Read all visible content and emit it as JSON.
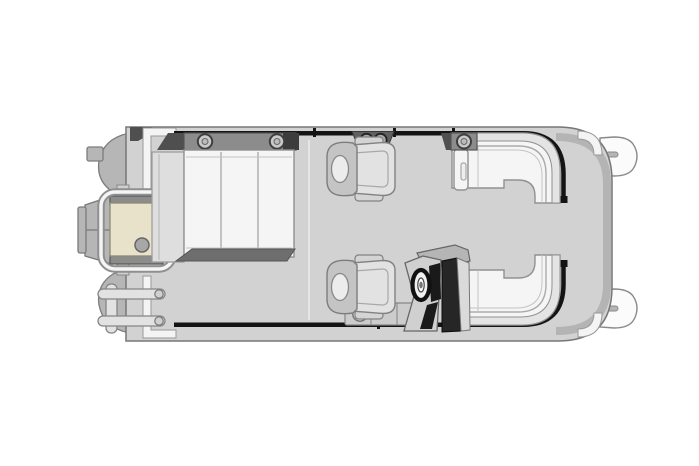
{
  "meta": {
    "description": "Top-view pontoon boat floor plan line drawing",
    "background": "#ffffff"
  },
  "colors": {
    "bg": "#ffffff",
    "deck": "#d2d2d2",
    "deckStroke": "#777777",
    "rim": "#b4b4b4",
    "pontoon": "#b6b6b6",
    "pontoonStroke": "#7c7c7c",
    "pontoonDark": "#9a9a9a",
    "fence": "#141414",
    "cushion": "#f5f5f5",
    "cushionBand": "#e4e4e4",
    "cushionStroke": "#919191",
    "whiteTrim": "#f4f4f4",
    "darkTrim": "#4f4f4f",
    "backBar": "#8c8c8c",
    "barDark": "#6e6e6e",
    "ring": "#c9c9c9",
    "chairBack": "#c4c4c4",
    "chairSeat": "#e2e2e2",
    "chairArm": "#d4d4d4",
    "headrest": "#ececec",
    "platformTan": "#e9e2cb",
    "motor": "#b6b6b6",
    "ladder": "#e2e2e2",
    "consoleBody": "#d0d0d0",
    "consoleDark": "#1a1a1a"
  },
  "parts": {
    "boat": "Pontoon boat floor plan, top view, bow at right",
    "deck": "Main deck platform",
    "pontoon_port": "Port pontoon tube (top)",
    "pontoon_starboard": "Starboard pontoon tube (bottom)",
    "nose_cone_port": "Port pontoon nose cone",
    "nose_cone_starboard": "Starboard pontoon nose cone",
    "fence": "Perimeter fence rail",
    "swim_platform": "Stern swim platform with grab rail",
    "motor": "Outboard motor pod",
    "ladder": "Stern boarding ladder",
    "rear_lounge": "Rear lounge bench with three cushions",
    "lounge_back_bar": "Lounge backrest bar with cup holders",
    "captain_chair_port": "Port captain's chair",
    "helm_chair": "Helm captain's chair",
    "helm_console": "Helm console with windscreen",
    "steering_wheel": "Steering wheel",
    "bow_seat_port": "Port bow L-shaped seat",
    "bow_seat_starboard": "Starboard bow L-shaped seat",
    "bow_gate": "Bow boarding gate opening"
  }
}
